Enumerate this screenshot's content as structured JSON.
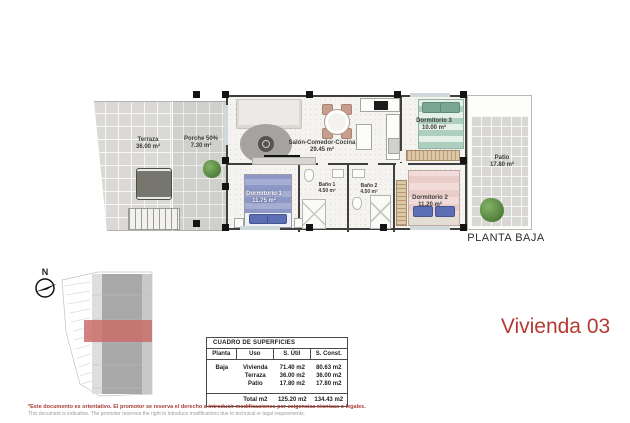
{
  "plan": {
    "title": "PLANTA BAJA",
    "rooms": [
      {
        "id": "terraza",
        "label": "Terraza",
        "area": "36.00 m²"
      },
      {
        "id": "porche",
        "label": "Porche 50%",
        "area": "7.30 m²"
      },
      {
        "id": "salon",
        "label": "Salón-Comedor-Cocina",
        "area": "29.45 m²"
      },
      {
        "id": "dormitorio3",
        "label": "Dormitorio 3",
        "area": "10.00 m²"
      },
      {
        "id": "patio",
        "label": "Patio",
        "area": "17.80 m²"
      },
      {
        "id": "dormitorio1",
        "label": "Dormitorio 1",
        "area": "11.75 m²"
      },
      {
        "id": "bano1",
        "label": "Baño 1",
        "area": "4.50 m²"
      },
      {
        "id": "bano2",
        "label": "Baño 2",
        "area": "4.50 m²"
      },
      {
        "id": "dormitorio2",
        "label": "Dormitorio 2",
        "area": "11.20 m²"
      }
    ]
  },
  "unit": {
    "title": "Vivienda 03",
    "accent_color": "#b53a31"
  },
  "compass": {
    "label": "N"
  },
  "site_plan": {
    "highlight_color": "#c96f68"
  },
  "surface_table": {
    "title": "CUADRO DE SUPERFICIES",
    "headers": [
      "Planta",
      "Uso",
      "S. Útil",
      "S. Const."
    ],
    "rows": [
      {
        "planta": "Baja",
        "uso": "Vivienda",
        "util": "71.40 m2",
        "const": "80.63 m2"
      },
      {
        "planta": "",
        "uso": "Terraza",
        "util": "36.00 m2",
        "const": "36.00 m2"
      },
      {
        "planta": "",
        "uso": "Patio",
        "util": "17.80 m2",
        "const": "17.80 m2"
      }
    ],
    "total": {
      "label": "Total m2",
      "util": "125.20 m2",
      "const": "134.43 m2"
    }
  },
  "disclaimer": {
    "es": "*Este documento es orientativo. El promotor se reserva el derecho a introducir modificaciones por exigencias técnicas o legales.",
    "en": "This document is indicative. The promoter reserves the right to introduce modifications due to technical or legal requirements."
  }
}
